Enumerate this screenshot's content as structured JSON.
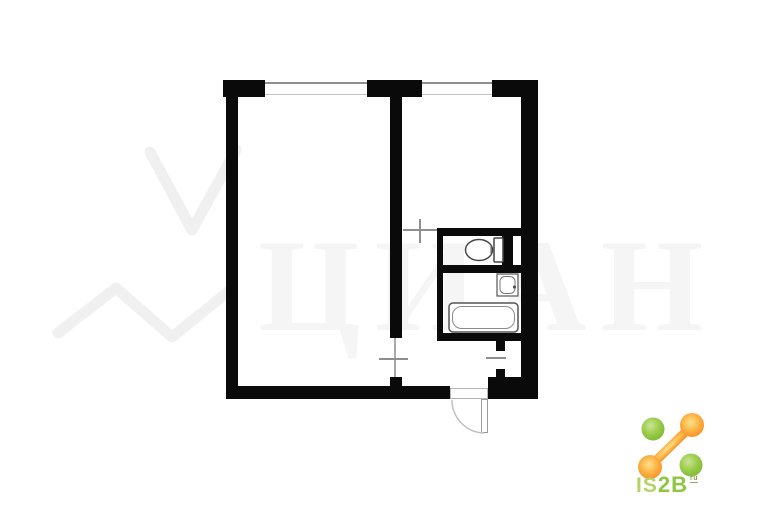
{
  "watermark": {
    "text": "ЦИАН",
    "color": "#f5f5f5"
  },
  "plan": {
    "wall_color": "#0a0a0a",
    "window_line_color": "#8f8f8f",
    "fixture_icons": [
      "toilet-icon",
      "sink-icon",
      "bathtub-icon",
      "entrance-door-icon",
      "window-icon"
    ]
  },
  "logo": {
    "text_main": "IS",
    "text_bold": "2B",
    "text_sup": "ru",
    "green": "#8dc63f",
    "light_green": "#b6d368",
    "orange": "#f58220"
  }
}
